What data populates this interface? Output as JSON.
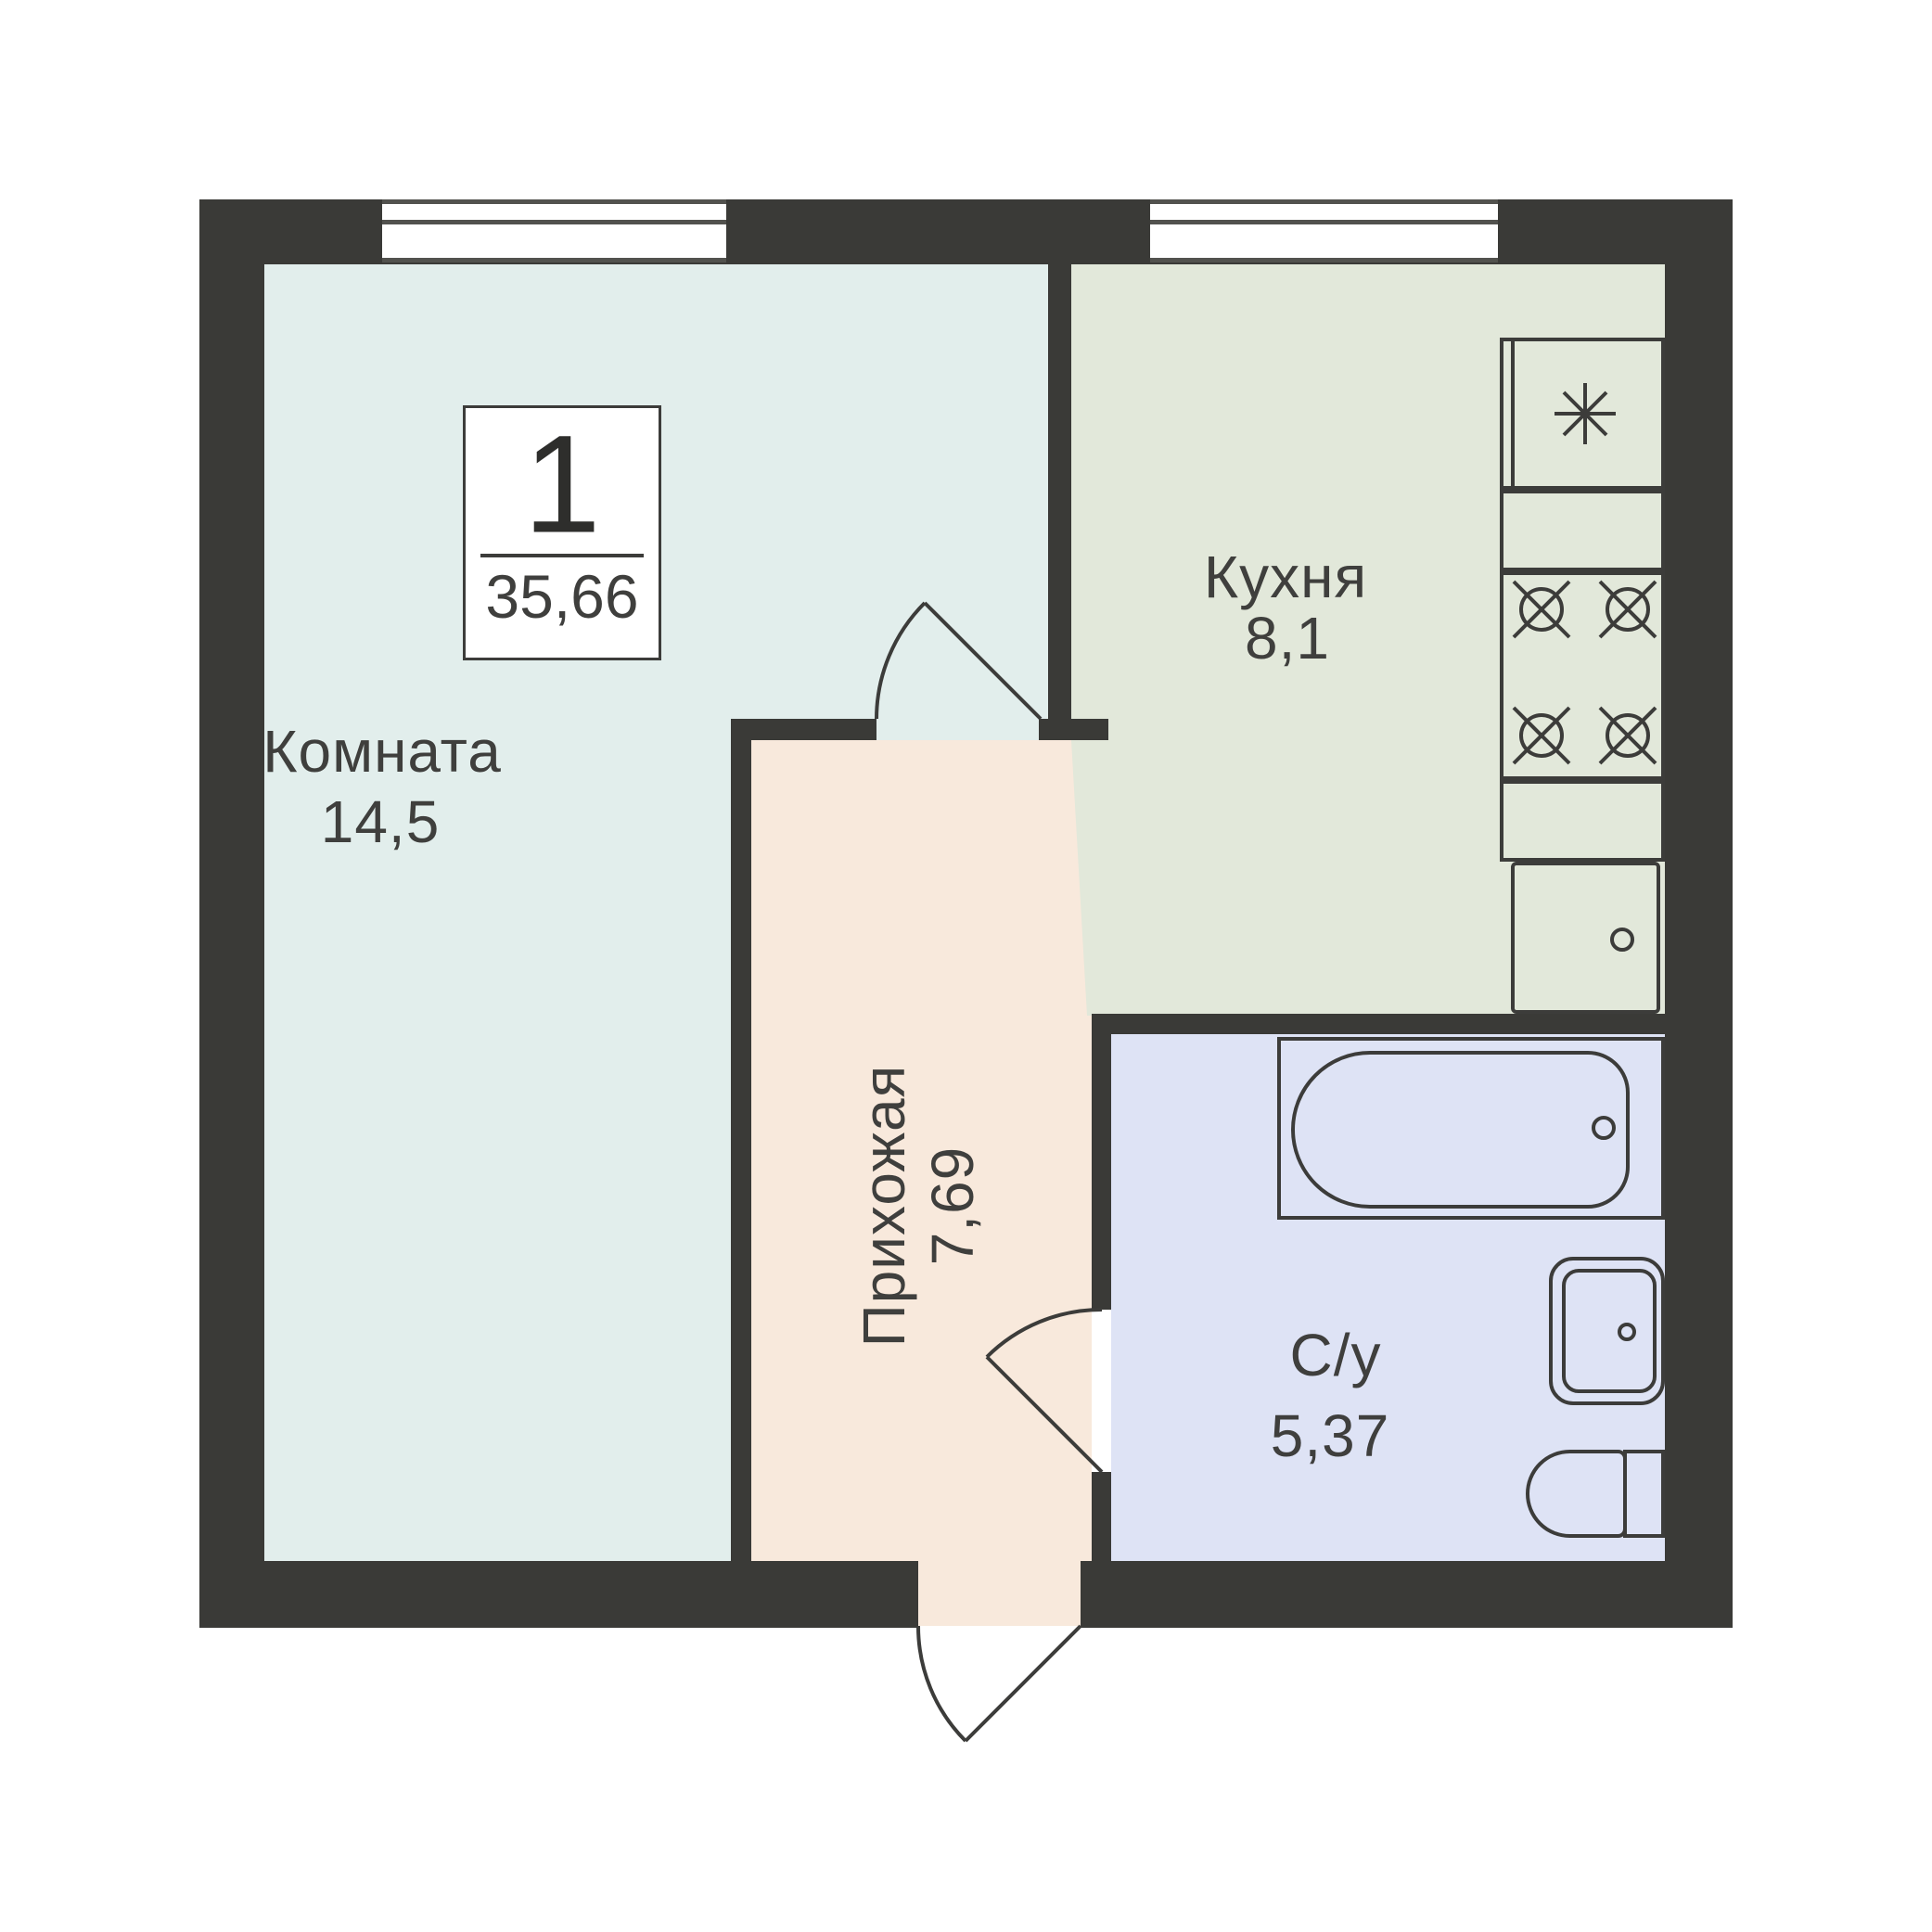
{
  "title": "Floor plan — 1-room apartment",
  "badge": {
    "number": "1",
    "total_area": "35,66"
  },
  "rooms": [
    {
      "id": "room",
      "name": "Комната",
      "area": "14,5"
    },
    {
      "id": "kitchen",
      "name": "Кухня",
      "area": "8,1"
    },
    {
      "id": "hall",
      "name": "Прихожая",
      "area": "7,69"
    },
    {
      "id": "bath",
      "name": "С/у",
      "area": "5,37"
    }
  ],
  "colors": {
    "wall": "#3a3a37",
    "outline": "#3c3c3a",
    "room_fill": "#e2eeec",
    "kitchen_fill": "#e2e8da",
    "hall_fill": "#f8e9dc",
    "bath_fill": "#dee3f5",
    "window_frame": "#52524e",
    "text": "#3f3f3d",
    "background": "#ffffff"
  },
  "icons": {
    "fridge": "snowflake-asterisk-icon",
    "stove_burner": "burner-circle-cross-icon",
    "kitchen_sink_drain": "circle-drain-icon",
    "bathtub_drain": "circle-drain-icon",
    "bathroom_sink_faucet": "circle-faucet-icon"
  }
}
